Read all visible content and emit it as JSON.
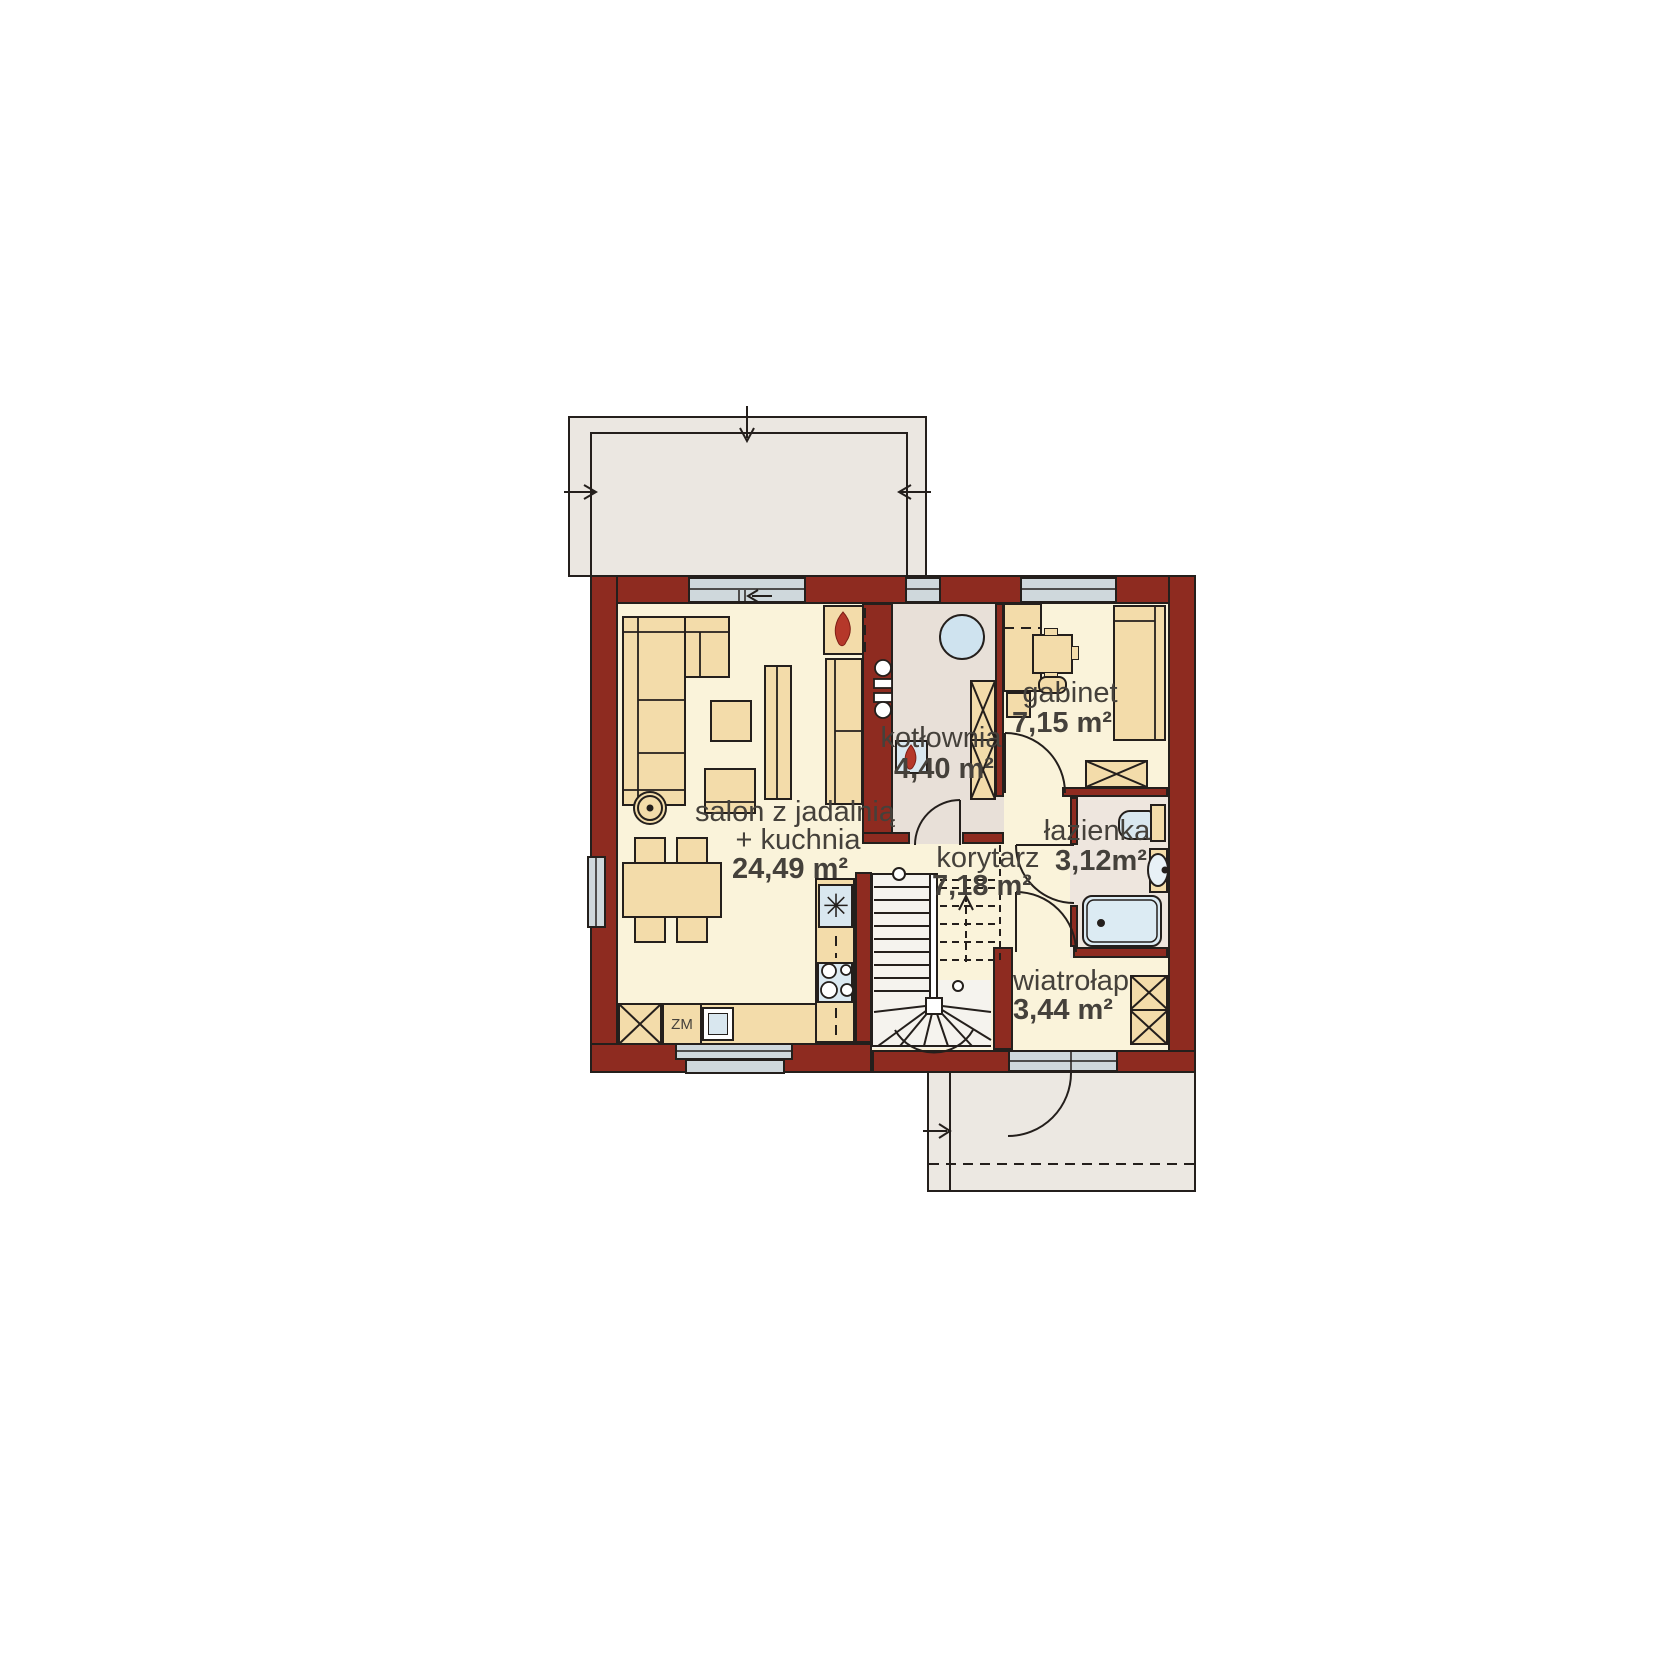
{
  "plan": {
    "rooms": {
      "salon": {
        "line1": "salon z jadalnią",
        "line2": "+ kuchnia",
        "area": "24,49 m²"
      },
      "kotlownia": {
        "name": "kotłownia",
        "area": "4,40 m²"
      },
      "gabinet": {
        "name": "gabinet",
        "area": "7,15 m²"
      },
      "korytarz": {
        "name": "korytarz",
        "area": "7,18 m²"
      },
      "lazienka": {
        "name": "łazienka",
        "area": "3,12m²"
      },
      "wiatrolap": {
        "name": "wiatrołap",
        "area": "3,44 m²"
      }
    },
    "labels": {
      "dishwasher": "ZM"
    },
    "icons": {
      "fireplace_flame": "flame-icon",
      "furnace_flame": "flame-icon",
      "sink_glyph": "✳"
    },
    "colors": {
      "wall": "#8e2b20",
      "outline": "#241f1c",
      "floor": "#faf3da",
      "utility_floor": "#e8e0d8",
      "bath_floor": "#eee6de",
      "furniture": "#f3dcaa",
      "terrace": "#ebe7e1",
      "porch": "#ece8e2",
      "window": "#cfd8dc",
      "fixture": "#d9e7ef",
      "flame": "#b5382a",
      "text": "#45413b"
    }
  }
}
